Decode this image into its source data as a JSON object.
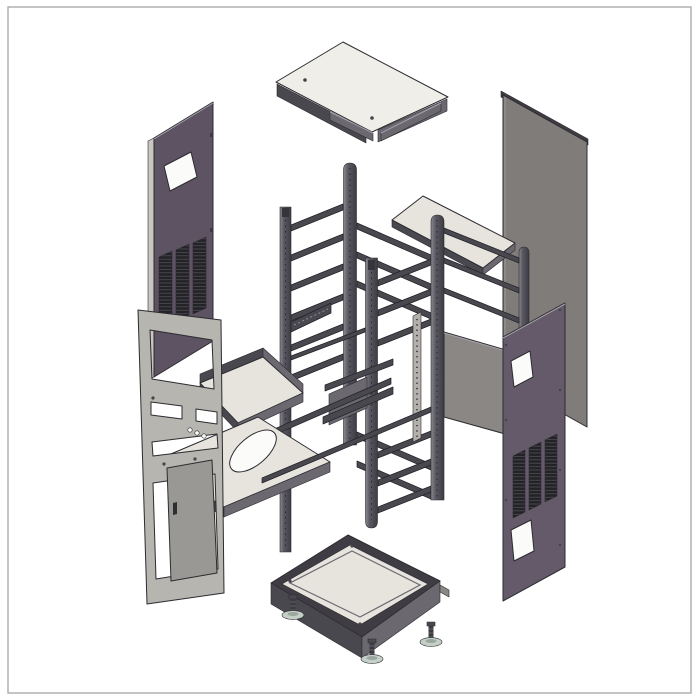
{
  "figure": {
    "type": "exploded-assembly-diagram",
    "subject": "Electrical enclosure / server rack cabinet exploded view",
    "canvas": {
      "width": 700,
      "height": 700,
      "has_border_frame": true
    },
    "visible_text": []
  },
  "palette": {
    "background": "#ffffff",
    "border": "#ababab",
    "line": "#2c2b30",
    "sheetLight": "#e6e4dd",
    "panelPurple": "#5e5362",
    "panelPurpleLight": "#655a69",
    "panelGray": "#7f7c7a",
    "panelGrayLight": "#8a8784",
    "railDark": "#4a484f",
    "railMid": "#6b6870",
    "frameGray": "#b7b5b0",
    "doorGray": "#9a9895",
    "ventDark": "#232227",
    "footBase": "#c4cfc8",
    "white": "#fbfbfa"
  },
  "parts": [
    {
      "id": "top-cover",
      "label": "Top cover panel with edge flanges and 2 screws"
    },
    {
      "id": "top-frame-bars",
      "label": "Top frame corner bars"
    },
    {
      "id": "side-panel-left",
      "label": "Left side panel with window cutout and vent grille"
    },
    {
      "id": "side-panel-right-rear",
      "label": "Right rear side panel (plain, inner face)"
    },
    {
      "id": "side-panel-right-front",
      "label": "Right front side panel with 2 windows and vent grille"
    },
    {
      "id": "shelf-upper-right",
      "label": "Upper equipment shelf (flat tray)"
    },
    {
      "id": "shelf-middle",
      "label": "Middle equipment shelf with raised rear lips"
    },
    {
      "id": "shelf-lower",
      "label": "Lower shelf with oval cable cutout"
    },
    {
      "id": "rack-frame",
      "label": "Rack mounting frame: 5 vertical rails with ladder rungs"
    },
    {
      "id": "support-braces",
      "label": "Diagonal support braces and brackets"
    },
    {
      "id": "rear-panel",
      "label": "Rear mounting plate (gray)"
    },
    {
      "id": "cage-nut-strip",
      "label": "Perforated cage-nut strip"
    },
    {
      "id": "front-bezel-frame",
      "label": "Front bezel frame with window and slot cutouts"
    },
    {
      "id": "access-door",
      "label": "Front access door with handle slot"
    },
    {
      "id": "base-panel",
      "label": "Base pan assembly with corner gussets"
    },
    {
      "id": "leveling-feet",
      "label": "Adjustable leveling feet",
      "visible_count": 3
    }
  ]
}
